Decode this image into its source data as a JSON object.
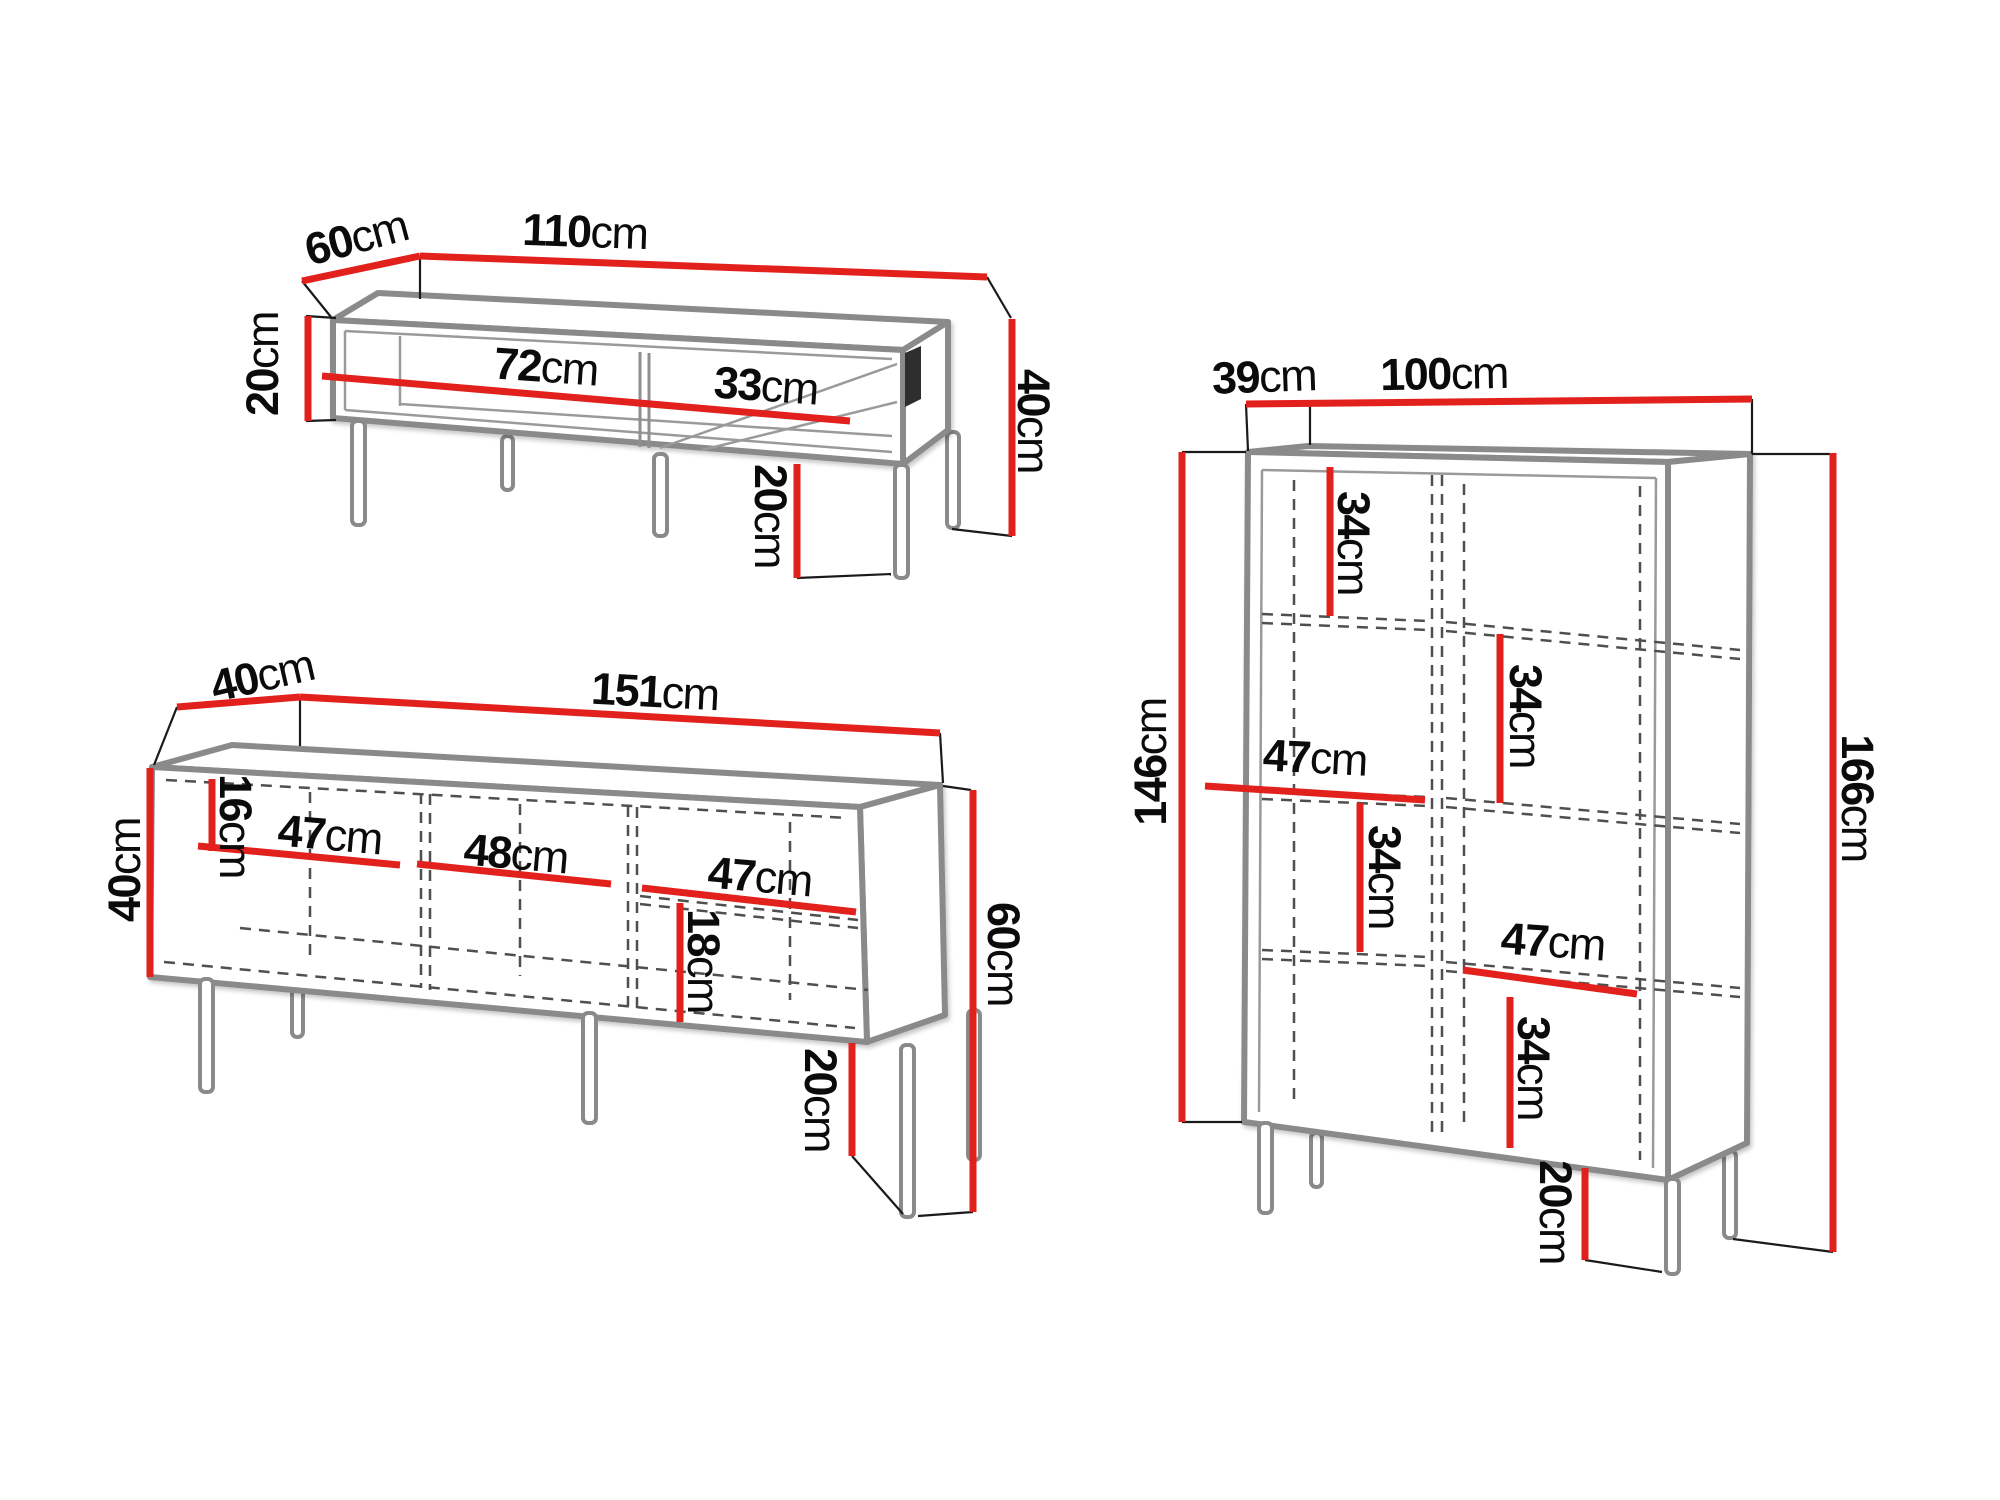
{
  "unit": "cm",
  "colors": {
    "dimension_red": "#e2211c",
    "outline_gray": "#8a8a8a",
    "thin_black": "#1a1a1a",
    "dashed_gray": "#4f4f4f",
    "label_text": "#0b0b0b",
    "background": "#ffffff"
  },
  "pieces": [
    {
      "id": "coffee-table",
      "labels": {
        "depth": {
          "value": "60",
          "unit": "cm"
        },
        "width": {
          "value": "110",
          "unit": "cm"
        },
        "carcass_height": {
          "value": "20",
          "unit": "cm"
        },
        "compartment_left": {
          "value": "72",
          "unit": "cm"
        },
        "compartment_right": {
          "value": "33",
          "unit": "cm"
        },
        "total_height": {
          "value": "40",
          "unit": "cm"
        },
        "leg_height": {
          "value": "20",
          "unit": "cm"
        }
      }
    },
    {
      "id": "sideboard",
      "labels": {
        "depth": {
          "value": "40",
          "unit": "cm"
        },
        "width": {
          "value": "151",
          "unit": "cm"
        },
        "carcass_height": {
          "value": "40",
          "unit": "cm"
        },
        "top_offset": {
          "value": "16",
          "unit": "cm"
        },
        "compartment_left": {
          "value": "47",
          "unit": "cm"
        },
        "compartment_middle": {
          "value": "48",
          "unit": "cm"
        },
        "compartment_right": {
          "value": "47",
          "unit": "cm"
        },
        "shelf_offset": {
          "value": "18",
          "unit": "cm"
        },
        "total_height": {
          "value": "60",
          "unit": "cm"
        },
        "leg_height": {
          "value": "20",
          "unit": "cm"
        }
      }
    },
    {
      "id": "display-cabinet",
      "labels": {
        "depth": {
          "value": "39",
          "unit": "cm"
        },
        "width": {
          "value": "100",
          "unit": "cm"
        },
        "carcass_height": {
          "value": "146",
          "unit": "cm"
        },
        "total_height": {
          "value": "166",
          "unit": "cm"
        },
        "left_top_section": {
          "value": "34",
          "unit": "cm"
        },
        "left_shelf_width": {
          "value": "47",
          "unit": "cm"
        },
        "left_mid_section": {
          "value": "34",
          "unit": "cm"
        },
        "right_top_section": {
          "value": "34",
          "unit": "cm"
        },
        "right_shelf_width": {
          "value": "47",
          "unit": "cm"
        },
        "right_bottom_section": {
          "value": "34",
          "unit": "cm"
        },
        "leg_height": {
          "value": "20",
          "unit": "cm"
        }
      }
    }
  ]
}
